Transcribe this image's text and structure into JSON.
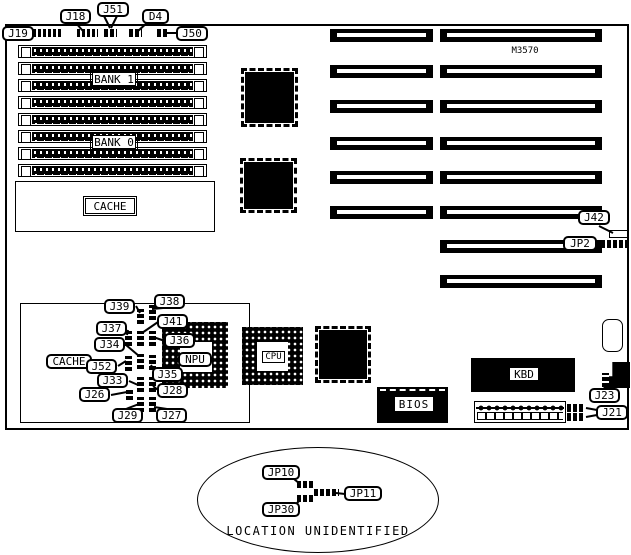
{
  "diagram": {
    "model": "M3570",
    "memory": {
      "bank1": "BANK 1",
      "bank0": "BANK 0"
    },
    "cache_top": "CACHE",
    "cache_bottom": "CACHE",
    "chips": {
      "npu": "NPU",
      "cpu": "CPU",
      "bios": "BIOS",
      "kbd": "KBD"
    },
    "callouts": {
      "j19": "J19",
      "j18": "J18",
      "j51": "J51",
      "d4": "D4",
      "j50": "J50",
      "j42": "J42",
      "jp2": "JP2",
      "j39": "J39",
      "j38": "J38",
      "j37": "J37",
      "j41": "J41",
      "j34": "J34",
      "j36": "J36",
      "j52": "J52",
      "j35": "J35",
      "j33": "J33",
      "j26": "J26",
      "j28": "J28",
      "j29": "J29",
      "j27": "J27",
      "j23": "J23",
      "j21": "J21",
      "jp10": "JP10",
      "jp11": "JP11",
      "jp30": "JP30"
    },
    "note": "LOCATION UNIDENTIFIED"
  }
}
